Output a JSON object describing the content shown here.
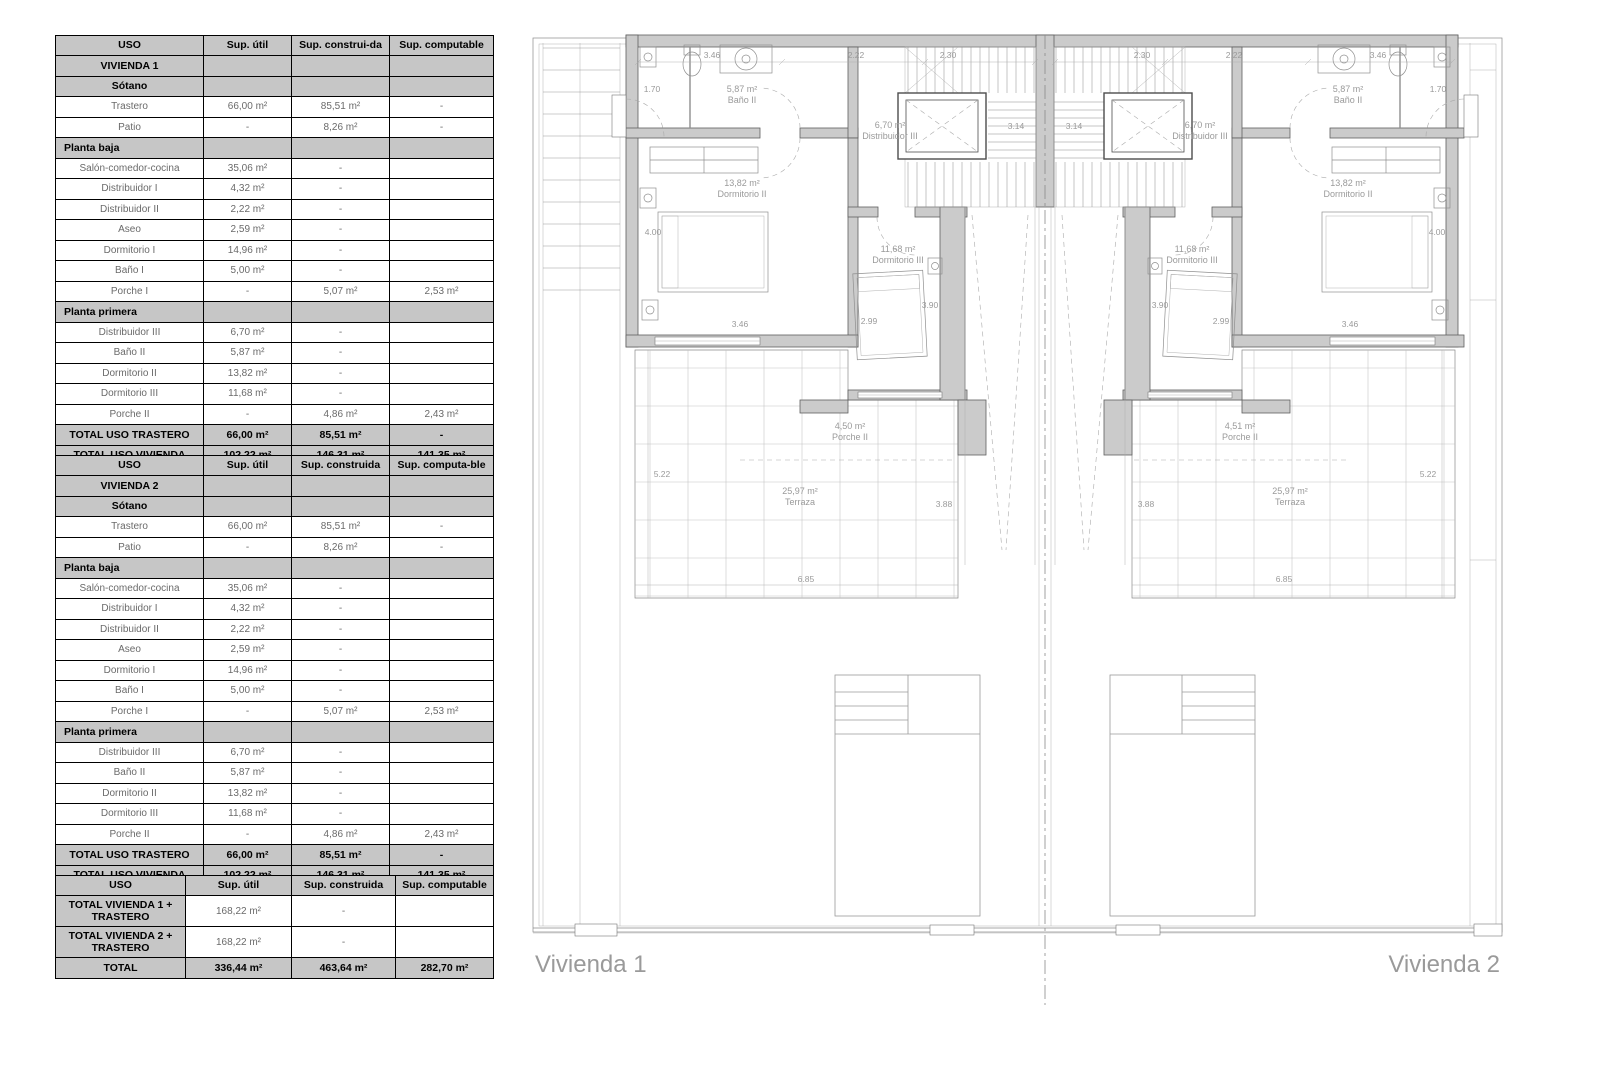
{
  "tables": {
    "vivienda1": {
      "headers": [
        "USO",
        "Sup. útil",
        "Sup. construi-da",
        "Sup. computable"
      ],
      "rows": [
        {
          "type": "section",
          "cells": [
            "VIVIENDA 1",
            "",
            "",
            ""
          ]
        },
        {
          "type": "section",
          "cells": [
            "Sótano",
            "",
            "",
            ""
          ]
        },
        {
          "type": "data",
          "cells": [
            "Trastero",
            "66,00 m²",
            "85,51 m²",
            "-"
          ]
        },
        {
          "type": "data",
          "cells": [
            "Patio",
            "-",
            "8,26 m²",
            "-"
          ]
        },
        {
          "type": "section",
          "align": "left",
          "cells": [
            "Planta baja",
            "",
            "",
            ""
          ]
        },
        {
          "type": "data",
          "cells": [
            "Salón-comedor-cocina",
            "35,06 m²",
            "-",
            ""
          ]
        },
        {
          "type": "data",
          "cells": [
            "Distribuidor I",
            "4,32 m²",
            "-",
            ""
          ]
        },
        {
          "type": "data",
          "cells": [
            "Distribuidor II",
            "2,22 m²",
            "-",
            ""
          ]
        },
        {
          "type": "data",
          "cells": [
            "Aseo",
            "2,59 m²",
            "-",
            ""
          ]
        },
        {
          "type": "data",
          "cells": [
            "Dormitorio I",
            "14,96 m²",
            "-",
            ""
          ]
        },
        {
          "type": "data",
          "cells": [
            "Baño I",
            "5,00 m²",
            "-",
            ""
          ]
        },
        {
          "type": "data",
          "cells": [
            "Porche I",
            "-",
            "5,07 m²",
            "2,53 m²"
          ]
        },
        {
          "type": "section",
          "align": "left",
          "cells": [
            "Planta primera",
            "",
            "",
            ""
          ]
        },
        {
          "type": "data",
          "cells": [
            "Distribuidor III",
            "6,70 m²",
            "-",
            ""
          ]
        },
        {
          "type": "data",
          "cells": [
            "Baño II",
            "5,87 m²",
            "-",
            ""
          ]
        },
        {
          "type": "data",
          "cells": [
            "Dormitorio II",
            "13,82 m²",
            "-",
            ""
          ]
        },
        {
          "type": "data",
          "cells": [
            "Dormitorio III",
            "11,68 m²",
            "-",
            ""
          ]
        },
        {
          "type": "data",
          "cells": [
            "Porche II",
            "-",
            "4,86 m²",
            "2,43 m²"
          ]
        },
        {
          "type": "total",
          "cells": [
            "TOTAL USO TRASTERO",
            "66,00 m²",
            "85,51 m²",
            "-"
          ]
        },
        {
          "type": "total",
          "cells": [
            "TOTAL USO VIVIENDA",
            "102,22 m²",
            "146,31 m²",
            "141,35 m²"
          ]
        }
      ]
    },
    "vivienda2": {
      "headers": [
        "USO",
        "Sup. útil",
        "Sup. construida",
        "Sup. computa-ble"
      ],
      "rows": [
        {
          "type": "section",
          "cells": [
            "VIVIENDA 2",
            "",
            "",
            ""
          ]
        },
        {
          "type": "section",
          "cells": [
            "Sótano",
            "",
            "",
            ""
          ]
        },
        {
          "type": "data",
          "cells": [
            "Trastero",
            "66,00 m²",
            "85,51 m²",
            "-"
          ]
        },
        {
          "type": "data",
          "cells": [
            "Patio",
            "-",
            "8,26 m²",
            "-"
          ]
        },
        {
          "type": "section",
          "align": "left",
          "cells": [
            "Planta baja",
            "",
            "",
            ""
          ]
        },
        {
          "type": "data",
          "cells": [
            "Salón-comedor-cocina",
            "35,06 m²",
            "-",
            ""
          ]
        },
        {
          "type": "data",
          "cells": [
            "Distribuidor I",
            "4,32 m²",
            "-",
            ""
          ]
        },
        {
          "type": "data",
          "cells": [
            "Distribuidor II",
            "2,22 m²",
            "-",
            ""
          ]
        },
        {
          "type": "data",
          "cells": [
            "Aseo",
            "2,59 m²",
            "-",
            ""
          ]
        },
        {
          "type": "data",
          "cells": [
            "Dormitorio I",
            "14,96 m²",
            "-",
            ""
          ]
        },
        {
          "type": "data",
          "cells": [
            "Baño I",
            "5,00 m²",
            "-",
            ""
          ]
        },
        {
          "type": "data",
          "cells": [
            "Porche I",
            "-",
            "5,07 m²",
            "2,53 m²"
          ]
        },
        {
          "type": "section",
          "align": "left",
          "cells": [
            "Planta primera",
            "",
            "",
            ""
          ]
        },
        {
          "type": "data",
          "cells": [
            "Distribuidor III",
            "6,70 m²",
            "-",
            ""
          ]
        },
        {
          "type": "data",
          "cells": [
            "Baño II",
            "5,87 m²",
            "-",
            ""
          ]
        },
        {
          "type": "data",
          "cells": [
            "Dormitorio II",
            "13,82 m²",
            "-",
            ""
          ]
        },
        {
          "type": "data",
          "cells": [
            "Dormitorio III",
            "11,68 m²",
            "-",
            ""
          ]
        },
        {
          "type": "data",
          "cells": [
            "Porche II",
            "-",
            "4,86 m²",
            "2,43 m²"
          ]
        },
        {
          "type": "total",
          "cells": [
            "TOTAL USO TRASTERO",
            "66,00 m²",
            "85,51 m²",
            "-"
          ]
        },
        {
          "type": "total",
          "cells": [
            "TOTAL USO VIVIENDA",
            "102,22 m²",
            "146,31 m²",
            "141,35 m²"
          ]
        }
      ]
    },
    "totals": {
      "headers": [
        "USO",
        "Sup. útil",
        "Sup. construida",
        "Sup. computable"
      ],
      "rows": [
        {
          "type": "total-label",
          "cells": [
            "TOTAL VIVIENDA 1 + TRASTERO",
            "168,22 m²",
            "-",
            ""
          ]
        },
        {
          "type": "total-label",
          "cells": [
            "TOTAL VIVIENDA 2 + TRASTERO",
            "168,22 m²",
            "-",
            ""
          ]
        },
        {
          "type": "total",
          "cells": [
            "TOTAL",
            "336,44 m²",
            "463,64 m²",
            "282,70 m²"
          ]
        }
      ]
    }
  },
  "plan": {
    "units": [
      {
        "name": "Vivienda 1",
        "rooms": {
          "bano": {
            "area": "5,87 m²",
            "name": "Baño II"
          },
          "distribuidor": {
            "area": "6,70 m²",
            "name": "Distribuidor III"
          },
          "dorm2": {
            "area": "13,82 m²",
            "name": "Dormitorio II"
          },
          "dorm3": {
            "area": "11,68 m²",
            "name": "Dormitorio III"
          },
          "porche": {
            "area": "4,50 m²",
            "name": "Porche II"
          },
          "terraza": {
            "area": "25,97 m²",
            "name": "Terraza"
          }
        },
        "dims": {
          "top": [
            "3.46",
            "2.22",
            "2.30"
          ],
          "left_upper": "1.70",
          "left_lower": "4.00",
          "bottom": [
            "3.46",
            "2.99",
            "3.90"
          ],
          "stair": "3.14",
          "terrace": [
            "5.22",
            "3.88",
            "6.85"
          ]
        }
      },
      {
        "name": "Vivienda 2",
        "rooms": {
          "bano": {
            "area": "5,87 m²",
            "name": "Baño II"
          },
          "distribuidor": {
            "area": "6,70 m²",
            "name": "Distribuidor III"
          },
          "dorm2": {
            "area": "13,82 m²",
            "name": "Dormitorio II"
          },
          "dorm3": {
            "area": "11,68 m²",
            "name": "Dormitorio III"
          },
          "porche": {
            "area": "4,51 m²",
            "name": "Porche II"
          },
          "terraza": {
            "area": "25,97 m²",
            "name": "Terraza"
          }
        },
        "dims": {
          "top": [
            "3.46",
            "2.22",
            "2.30"
          ],
          "left_upper": "1.70",
          "left_lower": "4.00",
          "bottom": [
            "3.46",
            "2.99",
            "3.90"
          ],
          "stair": "3.14",
          "terrace": [
            "5.22",
            "3.88",
            "6.85"
          ]
        }
      }
    ]
  }
}
